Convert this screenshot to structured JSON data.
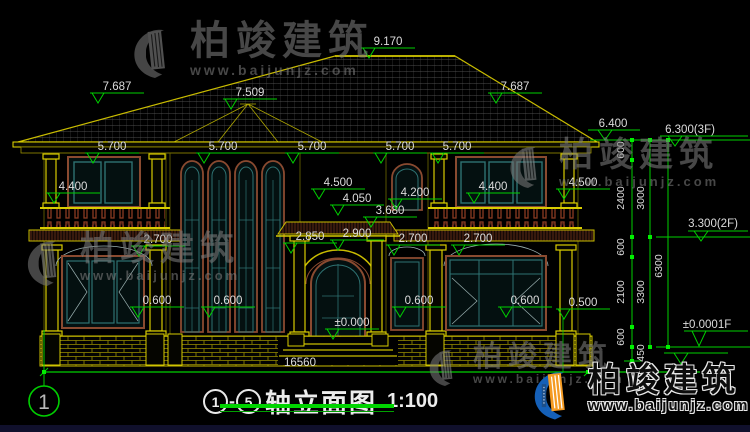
{
  "watermark": {
    "brand": "柏竣建筑",
    "url": "www.baijunjz.com"
  },
  "footer_logo": {
    "brand": "柏竣建筑",
    "url": "www.baijunjz.com"
  },
  "title_block": {
    "axis_from": "1",
    "sep": "-",
    "axis_to": "5",
    "title": "轴立面图",
    "scale": "1:100"
  },
  "axis_bubble": "1",
  "dims": {
    "k9170": "9.170",
    "k7687": "7.687",
    "k7509": "7.509",
    "k6400": "6.400",
    "k6300_3f": "6.300(3F)",
    "k3300_2f": "3.300(2F)",
    "k0000_1f": "±0.0001F",
    "k5700": "5.700",
    "k4400": "4.400",
    "k4500": "4.500",
    "k4050": "4.050",
    "k4200": "4.200",
    "k3680": "3.680",
    "k2850": "2.850",
    "k2900": "2.900",
    "k2700": "2.700",
    "k0600": "0.600",
    "k0500": "0.500",
    "k0000": "±0.000",
    "v600": "600",
    "v2400": "2400",
    "v3000": "3000",
    "v2100": "2100",
    "v3300": "3300",
    "v6300": "6300",
    "v450": "450",
    "total": "16560"
  },
  "colors": {
    "line_yellow": "#c9bc00",
    "dim_green": "#00cf00",
    "glass_teal": "#2e7272",
    "frame_brown": "#8a4a30",
    "dim_text": "#dcdcdc",
    "logo_blue": "#1560b8",
    "logo_orange": "#f59b22"
  }
}
